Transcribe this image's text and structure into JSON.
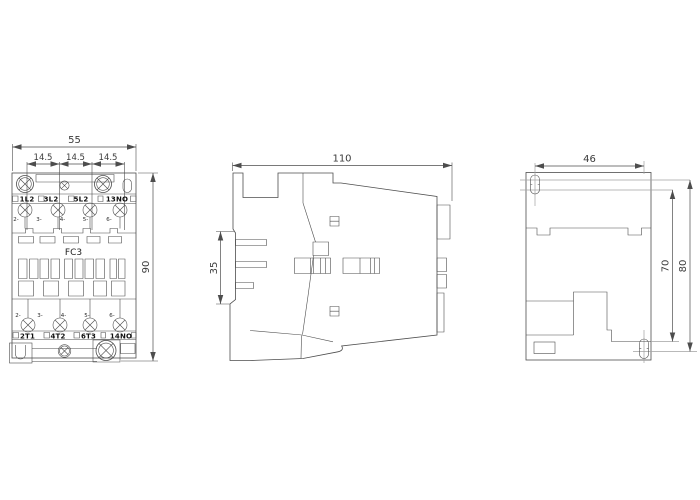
{
  "drawing": {
    "front_view": {
      "dim_width": "55",
      "dim_pitch_1": "14.5",
      "dim_pitch_2": "14.5",
      "dim_pitch_3": "14.5",
      "dim_height": "90",
      "model": "FC3",
      "top_terminals": [
        "1L2",
        "3L2",
        "5L2",
        "13NO"
      ],
      "bottom_terminals": [
        "2T1",
        "4T2",
        "6T3",
        "14NO"
      ],
      "top_marks": [
        "2-",
        "3-",
        "4-",
        "5-",
        "6-"
      ],
      "bottom_marks": [
        "2-",
        "3-",
        "4-",
        "5-",
        "6-"
      ]
    },
    "side_view": {
      "dim_depth": "110",
      "dim_rail_height": "35"
    },
    "back_view": {
      "dim_hole_spacing": "46",
      "dim_hole_height": "70",
      "dim_overall_height": "80"
    },
    "colors": {
      "line": "#4d4d4d",
      "light_line": "#a3a3a3",
      "text": "#3a3a3a",
      "background": "#ffffff"
    }
  }
}
